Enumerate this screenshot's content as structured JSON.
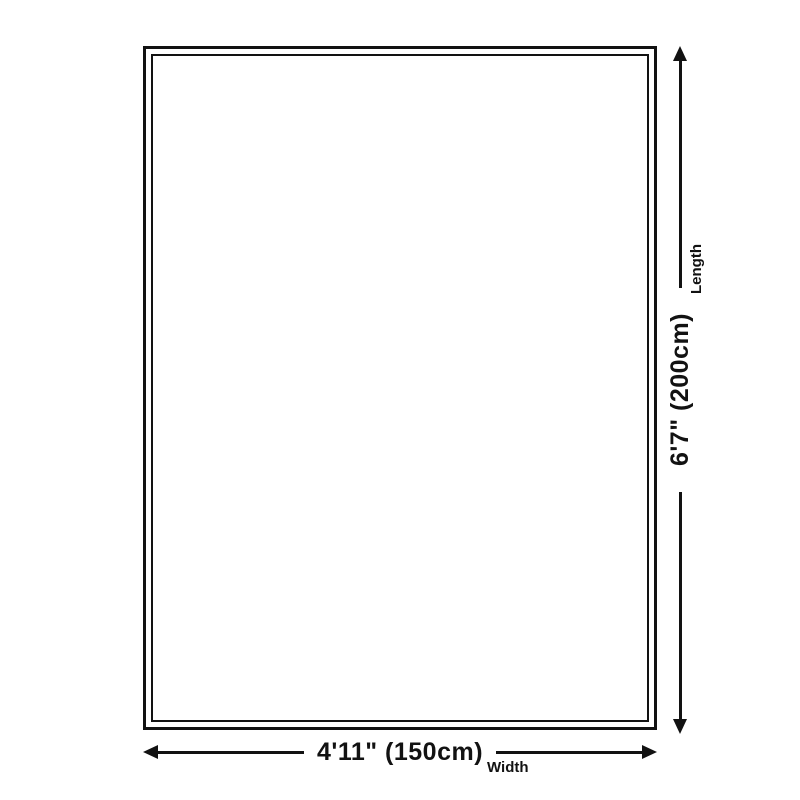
{
  "diagram": {
    "width": {
      "value": "4'11\" (150cm)",
      "label": "Width"
    },
    "length": {
      "value": "6'7\" (200cm)",
      "label": "Length"
    },
    "colors": {
      "ink": "#121212",
      "background": "#ffffff"
    }
  }
}
